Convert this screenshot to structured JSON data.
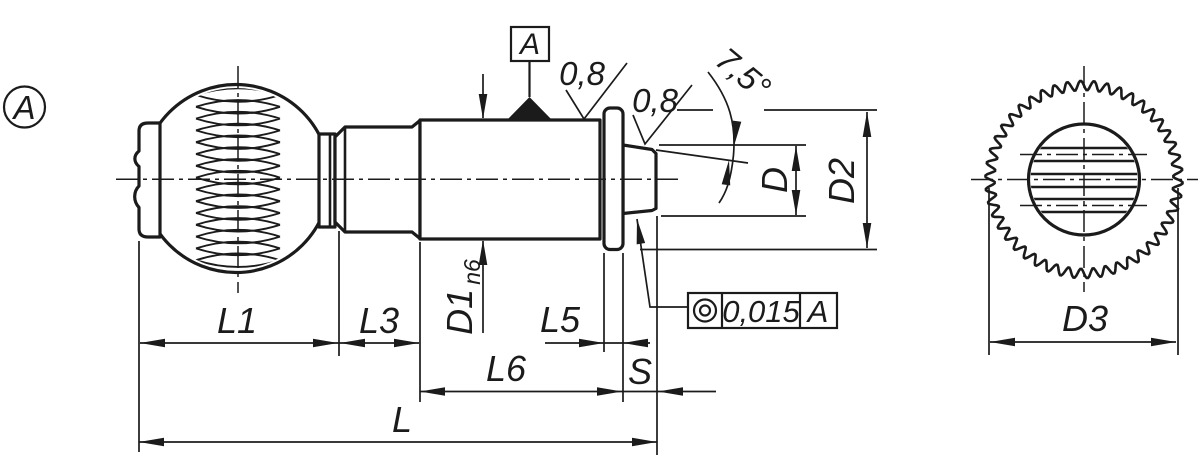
{
  "labels": {
    "view_marker": "A",
    "datum_flag": "A",
    "roughness_shank": "0,8",
    "roughness_pin": "0,8",
    "taper_angle": "7,5°"
  },
  "fcf": {
    "characteristic": "concentricity",
    "tolerance_value": "0,015",
    "datum_reference": "A"
  },
  "dims": {
    "l1": "L1",
    "l3": "L3",
    "l5": "L5",
    "l6": "L6",
    "l": "L",
    "s": "S",
    "d1": "D1",
    "d1_fit": "n6",
    "d": "D",
    "d2": "D2",
    "d3": "D3"
  },
  "colors": {
    "ink": "#1b1b1b",
    "paper": "#ffffff"
  }
}
